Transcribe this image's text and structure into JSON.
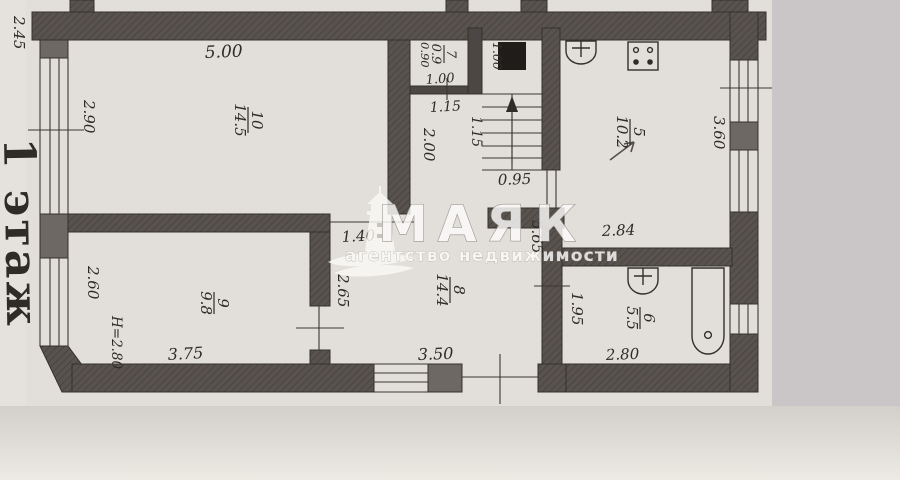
{
  "floor": {
    "label": "1 этаж"
  },
  "watermark": {
    "title": "МАЯК",
    "subtitle": "агентство недвижимости",
    "icon": "lighthouse-icon"
  },
  "rooms": [
    {
      "id": "room-10",
      "number": "10",
      "area": "14.5"
    },
    {
      "id": "room-7",
      "number": "7",
      "area": "0.9"
    },
    {
      "id": "room-5",
      "number": "5",
      "area": "10.2"
    },
    {
      "id": "room-8",
      "number": "8",
      "area": "14.4"
    },
    {
      "id": "room-9",
      "number": "9",
      "area": "9.8"
    },
    {
      "id": "room-6",
      "number": "6",
      "area": "5.5"
    }
  ],
  "dimensions": {
    "d245": "2.45",
    "d500": "5.00",
    "d290": "2.90",
    "d090": "0.90",
    "d100_room7": "1.00",
    "d100_flue": "1.00",
    "d115_h": "1.15",
    "d115_v": "1.15",
    "d200": "2.00",
    "d095": "0.95",
    "d360": "3.60",
    "d284": "2.84",
    "d565": "5.65",
    "d140": "1.40",
    "d265": "2.65",
    "d260": "2.60",
    "d375": "3.75",
    "d350": "3.50",
    "d195": "1.95",
    "d280_bath": "2.80",
    "height_note": "Н=2.80"
  },
  "colors": {
    "paper": "#e2ded9",
    "paper_margin": "#cac6c8",
    "wall": "#59534f",
    "pier": "#6e6864",
    "line": "#3b3734",
    "text": "#2f2b29",
    "watermark": "#ffffff"
  }
}
